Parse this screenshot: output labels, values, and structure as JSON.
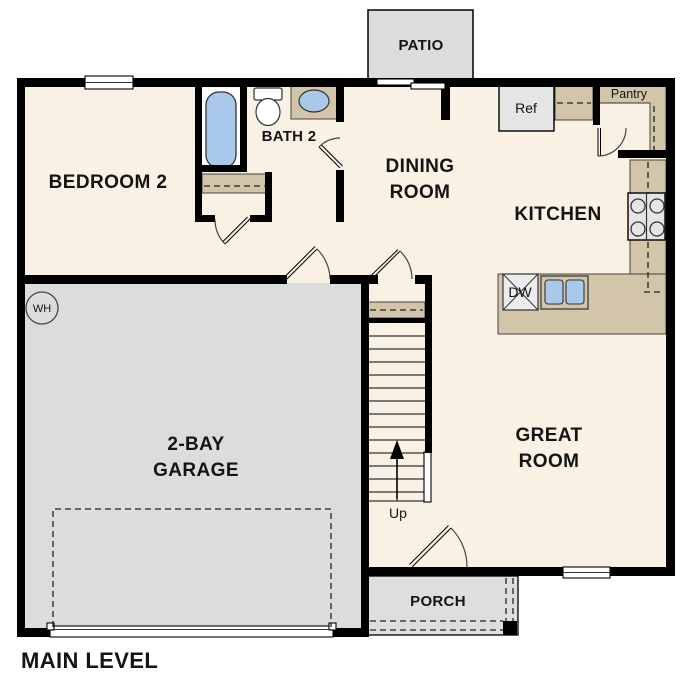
{
  "plan": {
    "plan_title": "MAIN LEVEL",
    "rooms": {
      "bedroom2": {
        "label": "BEDROOM 2"
      },
      "bath2": {
        "label": "BATH 2"
      },
      "dining": {
        "line1": "DINING",
        "line2": "ROOM"
      },
      "kitchen": {
        "label": "KITCHEN"
      },
      "great_room": {
        "line1": "GREAT",
        "line2": "ROOM"
      },
      "garage": {
        "line1": "2-BAY",
        "line2": "GARAGE"
      },
      "patio": {
        "label": "PATIO"
      },
      "porch": {
        "label": "PORCH"
      },
      "pantry": {
        "label": "Pantry"
      }
    },
    "fixtures": {
      "refrigerator": "Ref",
      "dishwasher": "DW",
      "water_heater": "WH",
      "stairs_direction": "Up"
    },
    "colors": {
      "floor": "#f8f1e4",
      "garage_floor": "#dcdcdc",
      "patio": "#dcdcdc",
      "porch": "#dedede",
      "counter": "#d3c5a9",
      "appliance": "#e5e5e5",
      "fixture_blue": "#a9c9ea",
      "wall": "#000000",
      "background": "#ffffff"
    }
  }
}
